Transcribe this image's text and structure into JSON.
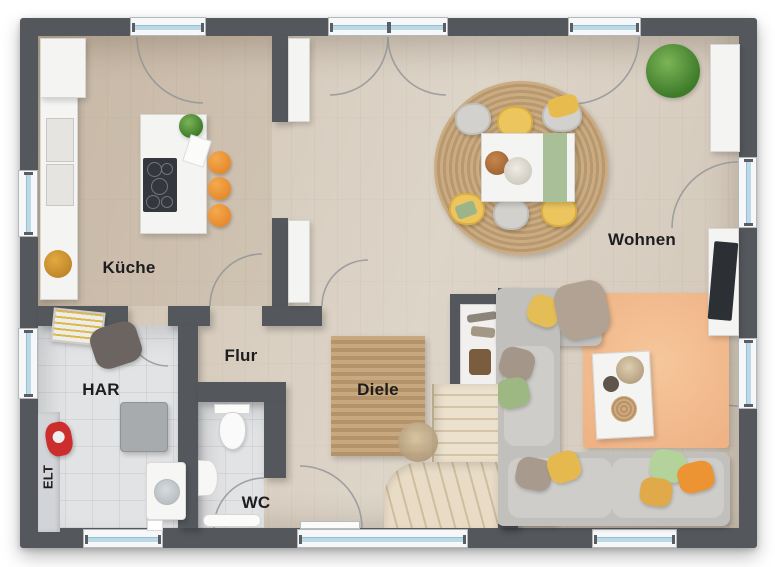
{
  "plan": {
    "rooms": {
      "kueche": {
        "label": "Küche"
      },
      "wohnen": {
        "label": "Wohnen"
      },
      "flur": {
        "label": "Flur"
      },
      "har": {
        "label": "HAR"
      },
      "diele": {
        "label": "Diele"
      },
      "wc": {
        "label": "WC"
      },
      "elt": {
        "label": "ELT"
      }
    },
    "colors": {
      "wall": "#54585c",
      "floor_wood": "#d8cec0",
      "floor_tile": "#e2e3e5",
      "window_glass": "#bcd9e8",
      "rug_jute": "#c0a178",
      "rug_peach": "#f3c093",
      "sofa_gray": "#c6c4c0",
      "stool_orange": "#ef9636",
      "pillow_yellow": "#e5bd56",
      "pillow_green": "#9db883",
      "pillow_orange": "#ec9434",
      "stairs_wood": "#e0d2b8"
    }
  }
}
